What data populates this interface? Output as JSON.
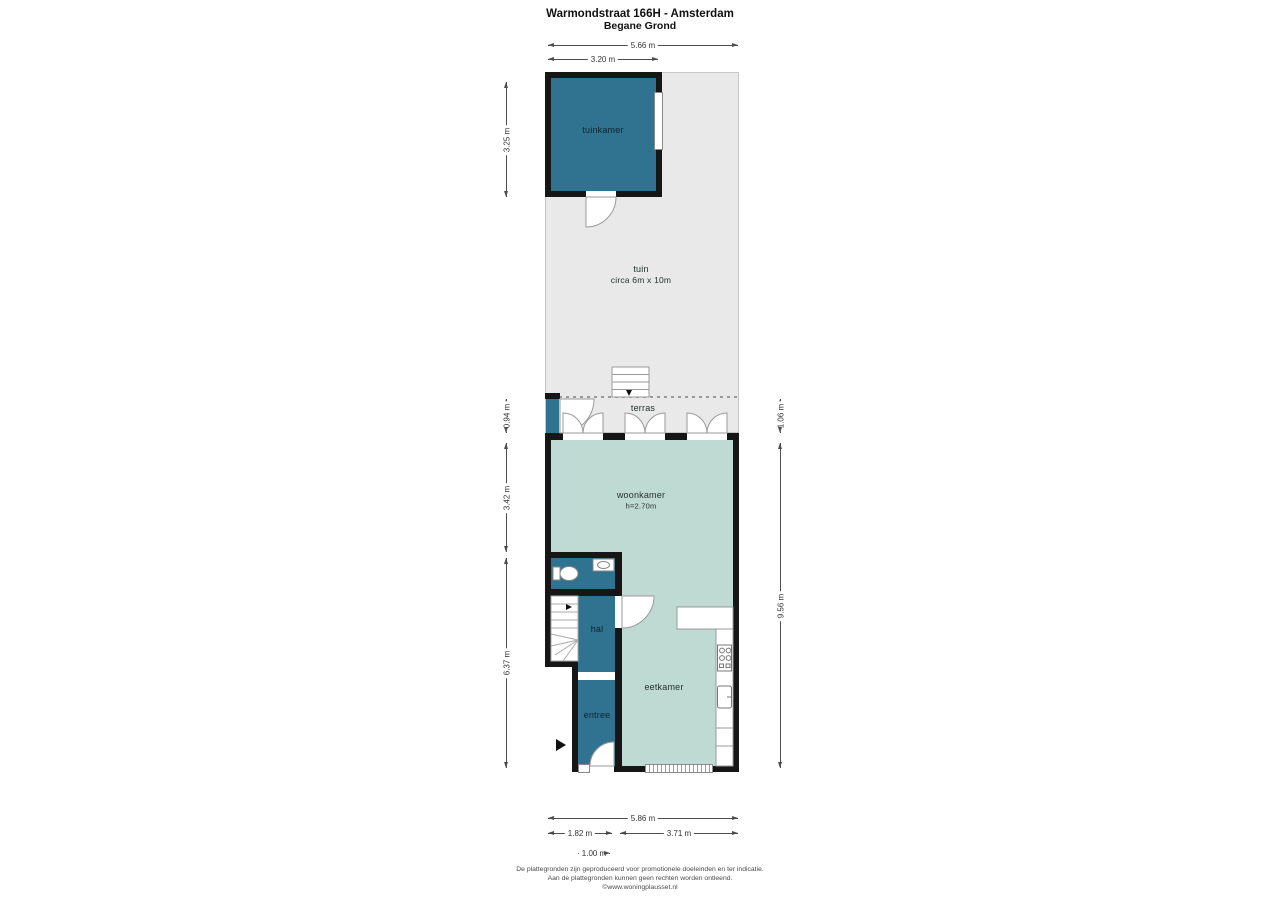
{
  "title": {
    "line1": "Warmondstraat 166H - Amsterdam",
    "line2": "Begane Grond"
  },
  "rooms": {
    "tuinkamer": "tuinkamer",
    "tuin": {
      "name": "tuin",
      "size": "circa 6m x 10m"
    },
    "terras": "terras",
    "woonkamer": {
      "name": "woonkamer",
      "height": "h=2.70m"
    },
    "hal": "hal",
    "eetkamer": "eetkamer",
    "entree": "entree"
  },
  "dimensions": {
    "top_total": "5.66 m",
    "top_tuinkamer": "3.20 m",
    "left_tuinkamer": "3.25 m",
    "left_terras": "0.94 m",
    "left_woonkamer": "3.42 m",
    "left_rear": "6.37 m",
    "right_terras": "1.06 m",
    "right_total": "9.56 m",
    "bottom_total": "5.86 m",
    "bottom_front_left": "1.82 m",
    "bottom_front_right": "3.71 m",
    "bottom_entree": "1.00 m"
  },
  "footer": {
    "line1": "De plattegronden zijn geproduceerd voor promotionele doeleinden en ter indicatie.",
    "line2": "Aan de plattegronden kunnen geen rechten worden ontleend.",
    "line3": "©www.woningplausset.nl"
  },
  "colors": {
    "room_dark_teal": "#2f7391",
    "room_light_green": "#bedad3",
    "garden_gray": "#e9e9e9",
    "wall_black": "#161616"
  }
}
